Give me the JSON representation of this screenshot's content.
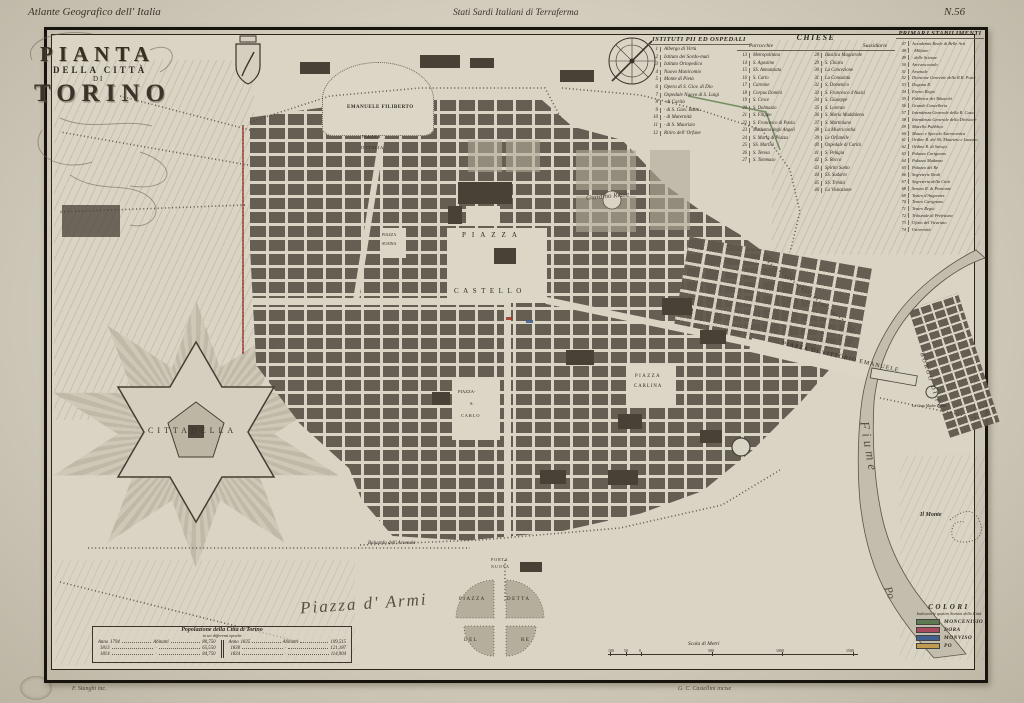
{
  "margins": {
    "series_title": "Atlante Geografico dell' Italia",
    "region_title": "Stati Sardi Italiani di Terraferma",
    "plate_number": "N.56",
    "credit_left": "F. Stanghi inc.",
    "credit_right": "G. C. Castellini incise"
  },
  "cartouche": {
    "line1": "PIANTA",
    "line2": "DELLA CITTÀ",
    "line3": "DI",
    "line4": "TORINO"
  },
  "legend": {
    "istituti": {
      "title": "ISTITUTI PII ED OSPEDALI",
      "items": [
        {
          "n": "1",
          "label": "Albergo di Virtù"
        },
        {
          "n": "2",
          "label": "Istituto dei Sordo-muti"
        },
        {
          "n": "3",
          "label": "Istituto Ortopedico"
        },
        {
          "n": "4",
          "label": "Nuovo Manicomio"
        },
        {
          "n": "5",
          "label": "Monte di Pietà"
        },
        {
          "n": "6",
          "label": "Opera di S. Giov. di Dio"
        },
        {
          "n": "7",
          "label": "Ospedale Nuovo di S. Luigi"
        },
        {
          "n": "8",
          "label": "·  di Carità"
        },
        {
          "n": "9",
          "label": "·  di S. Giov. Batta."
        },
        {
          "n": "10",
          "label": "·  di Maternità"
        },
        {
          "n": "11",
          "label": "·  di S. Maurizio"
        },
        {
          "n": "12",
          "label": "Ritiro dell' Orfane"
        }
      ]
    },
    "chiese": {
      "title": "CHIESE",
      "sub_left": "Parrocchie",
      "sub_right": "Sussidiarie",
      "parrocchie": [
        {
          "n": "13",
          "label": "Metropolitana"
        },
        {
          "n": "14",
          "label": "S. Agostino"
        },
        {
          "n": "15",
          "label": "SS. Annunziata"
        },
        {
          "n": "16",
          "label": "S. Carlo"
        },
        {
          "n": "17",
          "label": "Carmine"
        },
        {
          "n": "18",
          "label": "Corpus Domini"
        },
        {
          "n": "19",
          "label": "S. Croce"
        },
        {
          "n": "20",
          "label": "S. Dalmazzo"
        },
        {
          "n": "21",
          "label": "S. Filippo"
        },
        {
          "n": "22",
          "label": "S. Francesco di Paola"
        },
        {
          "n": "23",
          "label": "Madonna degli Angeli"
        },
        {
          "n": "24",
          "label": "S. Maria di Piazza"
        },
        {
          "n": "25",
          "label": "SS. Martiri"
        },
        {
          "n": "26",
          "label": "S. Teresa"
        },
        {
          "n": "27",
          "label": "S. Tommaso"
        }
      ],
      "sussidiarie": [
        {
          "n": "28",
          "label": "Basilica Magistrale"
        },
        {
          "n": "29",
          "label": "S. Chiara"
        },
        {
          "n": "30",
          "label": "La Concezione"
        },
        {
          "n": "31",
          "label": "La Consolata"
        },
        {
          "n": "32",
          "label": "S. Domenico"
        },
        {
          "n": "33",
          "label": "S. Francesco d'Assisi"
        },
        {
          "n": "34",
          "label": "S. Giuseppe"
        },
        {
          "n": "35",
          "label": "S. Lorenzo"
        },
        {
          "n": "36",
          "label": "S. Maria Maddalena"
        },
        {
          "n": "37",
          "label": "S. Martiniano"
        },
        {
          "n": "38",
          "label": "La Misericordia"
        },
        {
          "n": "39",
          "label": "Le Orfanelle"
        },
        {
          "n": "40",
          "label": "Ospedale di Carità"
        },
        {
          "n": "41",
          "label": "S. Pelagia"
        },
        {
          "n": "42",
          "label": "S. Rocco"
        },
        {
          "n": "43",
          "label": "Spirito Santo"
        },
        {
          "n": "44",
          "label": "SS. Sudario"
        },
        {
          "n": "45",
          "label": "SS. Trinità"
        },
        {
          "n": "46",
          "label": "La Visitazione"
        }
      ]
    },
    "stabilimenti": {
      "title": "PRIMARJ STABILIMENTI",
      "items": [
        {
          "n": "47",
          "label": "Accademia Reale di Belle Arti"
        },
        {
          "n": "48",
          "label": "·  Militare"
        },
        {
          "n": "49",
          "label": "·  delle Scienze"
        },
        {
          "n": "50",
          "label": "Arcivescovado"
        },
        {
          "n": "51",
          "label": "Arsenale"
        },
        {
          "n": "52",
          "label": "Divisione Generale delle R.R. Poste"
        },
        {
          "n": "53",
          "label": "Dogana R."
        },
        {
          "n": "54",
          "label": "Erario Regio"
        },
        {
          "n": "55",
          "label": "Fabbrica dei Tabacchi"
        },
        {
          "n": "56",
          "label": "Grande Cancelleria"
        },
        {
          "n": "57",
          "label": "Intendenza Generale della R. Casa"
        },
        {
          "n": "58",
          "label": "Intendenza Generale della Divisione"
        },
        {
          "n": "59",
          "label": "Macello Pubblico"
        },
        {
          "n": "60",
          "label": "Museo e Specola Astronomica"
        },
        {
          "n": "61",
          "label": "Ordine R. dei SS. Maurizio e Lazzaro"
        },
        {
          "n": "62",
          "label": "Ordine R. di Savoja"
        },
        {
          "n": "63",
          "label": "Palazzo Carignano"
        },
        {
          "n": "64",
          "label": "Palazzo Madama"
        },
        {
          "n": "65",
          "label": "Palazzo del Re"
        },
        {
          "n": "66",
          "label": "Segreterie Reali"
        },
        {
          "n": "67",
          "label": "Segreteria della Città"
        },
        {
          "n": "68",
          "label": "Senato R. di Piemonte"
        },
        {
          "n": "69",
          "label": "Teatro d'Angennes"
        },
        {
          "n": "70",
          "label": "Teatro Carignano"
        },
        {
          "n": "71",
          "label": "Teatro Regio"
        },
        {
          "n": "72",
          "label": "Tribunale di Prefettura"
        },
        {
          "n": "73",
          "label": "Ufizio del Vicariato"
        },
        {
          "n": "74",
          "label": "Università"
        }
      ]
    }
  },
  "map_labels": {
    "emanuele_filiberto": "EMANUELE FILIBERTO",
    "piazza_italia_1": "PIAZZA",
    "piazza_italia_2": "D'ITALIA",
    "piazza_susina_1": "PIAZZA",
    "piazza_susina_2": "SUSINA",
    "giardino_reale": "Giardino Reale",
    "piazza_castello_1": "PIAZZA",
    "piazza_castello_2": "CASTELLO",
    "vittorio_emanuele": "PIAZZA DI VITTORIO EMANUELE",
    "carlina_1": "PIAZZA",
    "carlina_2": "CARLINA",
    "s_carlo_1": "PIAZZA-",
    "s_carlo_2": "S.",
    "s_carlo_3": "CARLO",
    "cittadella": "CITTADELLA",
    "piazza_armi": "Piazza d' Armi",
    "baluardo": "Baluardo dell' Arsenale",
    "porta_nuova_1": "PORTA",
    "porta_nuova_2": "NUOVA",
    "del_re_1": "PIAZZA",
    "del_re_2": "DETTA",
    "del_re_3": "DEL",
    "del_re_4": "RE",
    "borgo_po": "BORGO DI PO",
    "fiume": "Fiume",
    "po": "Po",
    "il_monte": "Il Monte",
    "gran_madre": "La Gran Madre di Dio"
  },
  "population_table": {
    "title": "Popolazione della Città di Torino",
    "subtitle": "in sei differenti epoche",
    "rows_left": [
      {
        "a": "Anno",
        "y": "1794",
        "m": "Abitanti",
        "v": "80,750"
      },
      {
        "a": "",
        "y": "1813",
        "m": "·",
        "v": "65,550"
      },
      {
        "a": "",
        "y": "1814",
        "m": "·",
        "v": "84,750"
      }
    ],
    "rows_right": [
      {
        "a": "Anno",
        "y": "1825",
        "m": "Abitanti",
        "v": "109,515"
      },
      {
        "a": "",
        "y": "1830",
        "m": "·",
        "v": "121,187"
      },
      {
        "a": "",
        "y": "1834",
        "m": "·",
        "v": "114,904"
      }
    ]
  },
  "colori": {
    "title": "COLORI",
    "subtitle": "Indicanti le quattro Sezioni della Città",
    "entries": [
      {
        "label": "MONCENISIO",
        "color": "#5e7b50"
      },
      {
        "label": "DORA",
        "color": "#a84a5c"
      },
      {
        "label": "MONVISO",
        "color": "#41608e"
      },
      {
        "label": "PO",
        "color": "#bd9c4d"
      }
    ]
  },
  "scale": {
    "label": "Scala di Metri",
    "ticks": [
      "100",
      "50",
      "0",
      "500",
      "1000",
      "1500"
    ]
  }
}
